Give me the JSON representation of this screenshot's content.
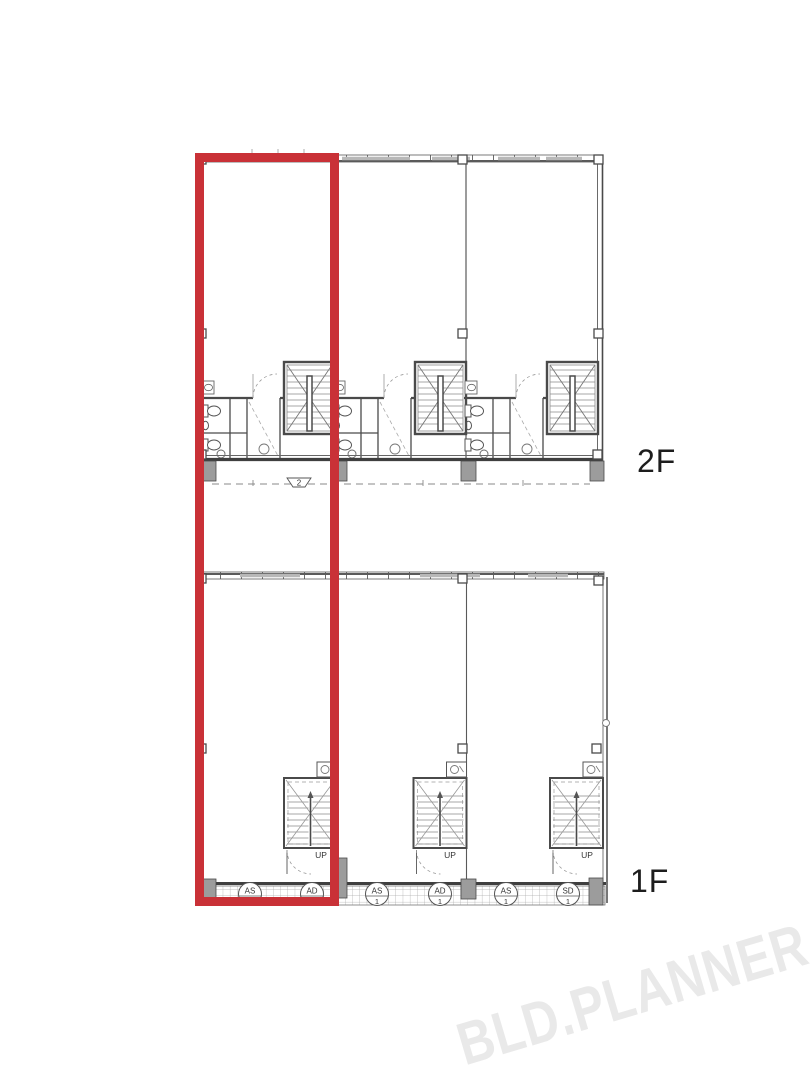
{
  "floors": {
    "upper": {
      "label": "2F",
      "balcony_marker": "2"
    },
    "lower": {
      "label": "1F",
      "stair_label": "UP",
      "porch_badges": [
        {
          "code": "AS",
          "num": "1"
        },
        {
          "code": "AD",
          "num": "1"
        },
        {
          "code": "AS",
          "num": "1"
        },
        {
          "code": "AD",
          "num": "1"
        },
        {
          "code": "AS",
          "num": "1"
        },
        {
          "code": "SD",
          "num": "1"
        }
      ]
    }
  },
  "highlight": {
    "color": "#c93137"
  },
  "colors": {
    "plan_line_dark": "#4a4a4a",
    "plan_line_light": "#8a8a8a",
    "column_fill": "#9c9c9c",
    "window_glaze": "#b8b8b8",
    "watermark_gray": "#e9e9e9",
    "label_text": "#1d1d1d",
    "background": "#ffffff"
  },
  "watermark": {
    "text": "BLD.PLANNER"
  }
}
